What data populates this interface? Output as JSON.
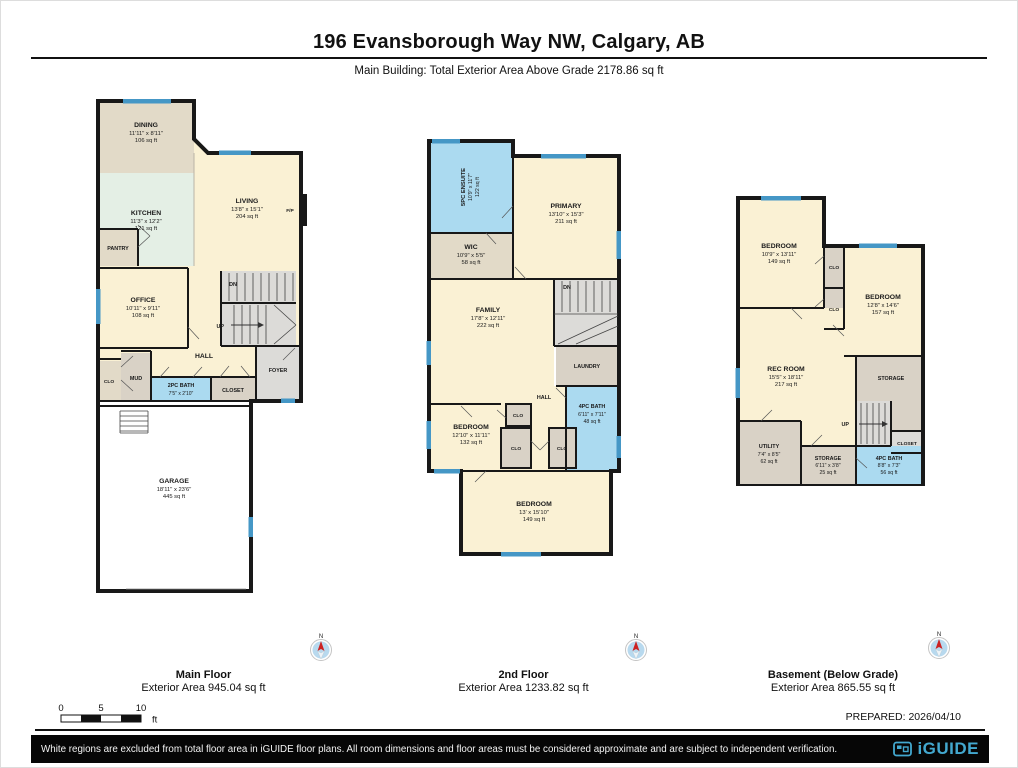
{
  "header": {
    "title": "196 Evansborough Way NW, Calgary, AB",
    "subtitle": "Main Building: Total Exterior Area Above Grade 2178.86 sq ft"
  },
  "compass": {
    "north": "N"
  },
  "scalebar": {
    "zero": "0",
    "five": "5",
    "ten": "10",
    "unit": "ft"
  },
  "prepared": "PREPARED: 2026/04/10",
  "footer": {
    "disclaimer": "White regions are excluded from total floor area in iGUIDE floor plans. All room dimensions and floor areas must be considered approximate and are subject to independent verification.",
    "brand": "iGUIDE"
  },
  "colors": {
    "room_cream": "#faf1d4",
    "room_tan": "#e2dac8",
    "room_taupe": "#d9d2c6",
    "room_gray": "#dcdbd8",
    "room_mint": "#e4efe5",
    "bath_blue": "#abdaf0",
    "window_blue": "#4597c6",
    "wall": "#181818",
    "brand_blue": "#43a8cf",
    "compass_red": "#cc2222"
  },
  "floors": {
    "main": {
      "caption": "Main Floor",
      "caption_area": "Exterior Area 945.04 sq ft",
      "rooms": {
        "dining": {
          "name": "DINING",
          "dims": "11'11\" x 8'11\"",
          "area": "106 sq ft"
        },
        "kitchen": {
          "name": "KITCHEN",
          "dims": "11'3\" x 12'2\"",
          "area": "121 sq ft"
        },
        "living": {
          "name": "LIVING",
          "dims": "13'8\" x 15'1\"",
          "area": "204 sq ft"
        },
        "fireplace": {
          "name": "F/P"
        },
        "pantry": {
          "name": "PANTRY"
        },
        "office": {
          "name": "OFFICE",
          "dims": "10'11\" x 9'11\"",
          "area": "108 sq ft"
        },
        "hall": {
          "name": "HALL"
        },
        "stairs_dn": {
          "name": "DN"
        },
        "stairs_up": {
          "name": "UP"
        },
        "clo": {
          "name": "CLO"
        },
        "mud": {
          "name": "MUD"
        },
        "bath": {
          "name": "2PC BATH",
          "dims": "7'5\" x 2'10\""
        },
        "closet": {
          "name": "CLOSET"
        },
        "foyer": {
          "name": "FOYER"
        },
        "garage": {
          "name": "GARAGE",
          "dims": "18'11\" x 23'6\"",
          "area": "445 sq ft"
        }
      }
    },
    "second": {
      "caption": "2nd Floor",
      "caption_area": "Exterior Area 1233.82 sq ft",
      "rooms": {
        "ensuite": {
          "name": "5PC ENSUITE",
          "dims": "10'9\" x 11'7\"",
          "area": "122 sq ft"
        },
        "primary": {
          "name": "PRIMARY",
          "dims": "13'10\" x 15'3\"",
          "area": "211 sq ft"
        },
        "wic": {
          "name": "WIC",
          "dims": "10'9\" x 5'5\"",
          "area": "58 sq ft"
        },
        "family": {
          "name": "FAMILY",
          "dims": "17'8\" x 12'11\"",
          "area": "222 sq ft"
        },
        "stairs_dn": {
          "name": "DN"
        },
        "laundry": {
          "name": "LAUNDRY"
        },
        "hall": {
          "name": "HALL"
        },
        "bedroom2": {
          "name": "BEDROOM",
          "dims": "12'10\" x 11'11\"",
          "area": "132 sq ft"
        },
        "clo1": {
          "name": "CLO"
        },
        "clo2": {
          "name": "CLO"
        },
        "clo3": {
          "name": "CLO"
        },
        "bath": {
          "name": "4PC BATH",
          "dims": "6'11\" x 7'11\"",
          "area": "48 sq ft"
        },
        "bedroom3": {
          "name": "BEDROOM",
          "dims": "13' x 15'10\"",
          "area": "149 sq ft"
        }
      }
    },
    "basement": {
      "caption": "Basement (Below Grade)",
      "caption_area": "Exterior Area 865.55 sq ft",
      "rooms": {
        "bedroom4": {
          "name": "BEDROOM",
          "dims": "10'9\" x 13'11\"",
          "area": "149 sq ft"
        },
        "clo1": {
          "name": "CLO"
        },
        "clo2": {
          "name": "CLO"
        },
        "bedroom5": {
          "name": "BEDROOM",
          "dims": "12'8\" x 14'6\"",
          "area": "157 sq ft"
        },
        "rec": {
          "name": "REC ROOM",
          "dims": "15'5\" x 18'11\"",
          "area": "217 sq ft"
        },
        "storage1": {
          "name": "STORAGE"
        },
        "stairs_up": {
          "name": "UP"
        },
        "closet": {
          "name": "CLOSET"
        },
        "utility": {
          "name": "UTILITY",
          "dims": "7'4\" x 8'5\"",
          "area": "62 sq ft"
        },
        "storage2": {
          "name": "STORAGE",
          "dims": "6'11\" x 3'8\"",
          "area": "25 sq ft"
        },
        "bath": {
          "name": "4PC BATH",
          "dims": "8'8\" x 7'3\"",
          "area": "56 sq ft"
        }
      }
    }
  }
}
